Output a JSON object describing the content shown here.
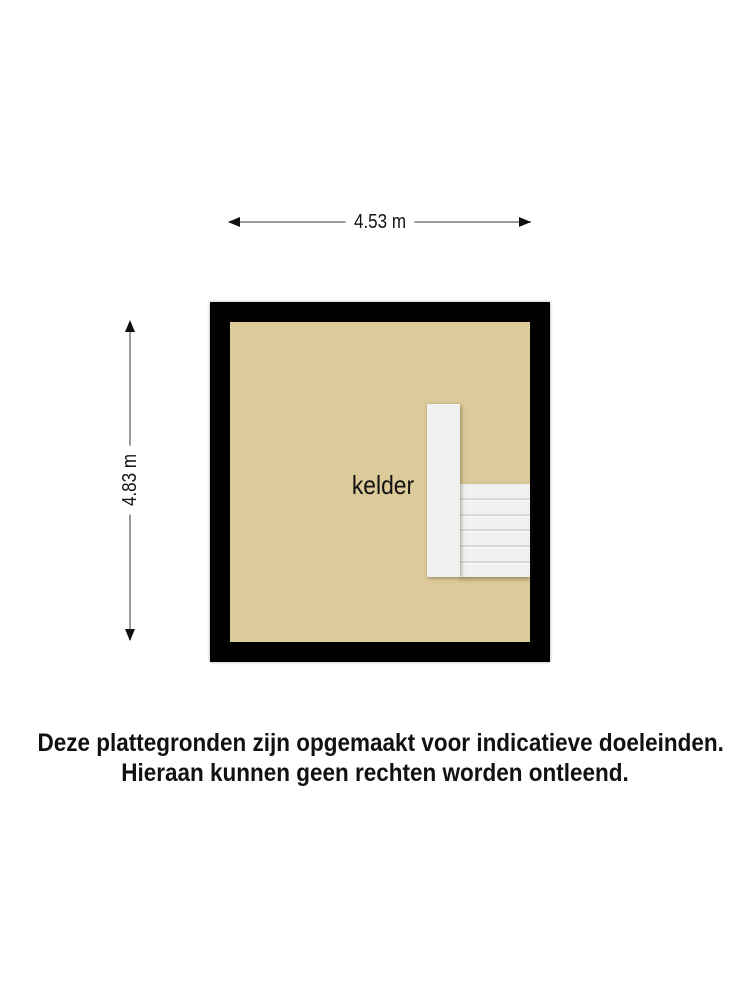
{
  "dimensions": {
    "width": {
      "label": "4.53 m"
    },
    "height": {
      "label": "4.83 m"
    }
  },
  "floorplan": {
    "room": {
      "label": "kelder"
    },
    "stairs": {
      "treads": 6
    },
    "colors": {
      "wall": "#000000",
      "floor": "#dcca9a",
      "stairs": "#f0f0f0",
      "stair_divider": "#d7d7d7",
      "dimension_line": "#9c9c9c",
      "text": "#111111"
    }
  },
  "disclaimer": {
    "line1": "Deze plattegronden zijn opgemaakt voor indicatieve doeleinden.",
    "line2": "Hieraan kunnen geen rechten worden ontleend."
  }
}
